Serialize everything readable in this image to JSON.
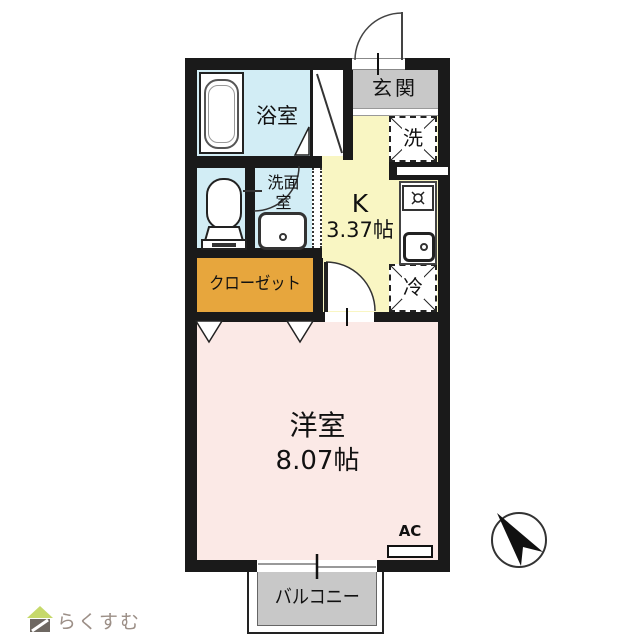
{
  "colors": {
    "wall": "#1a1a1a",
    "wet": "#d2edf5",
    "kitchen": "#f9f6c3",
    "closet": "#e7a63d",
    "bedroom": "#fbe9e6",
    "gray": "#c8c8c8",
    "logo-green": "#c6d96a",
    "logo-body": "#6e6862",
    "logo-text": "#9c8f87"
  },
  "rooms": {
    "entrance": {
      "label": "玄関"
    },
    "bathroom": {
      "label": "浴室"
    },
    "washroom": {
      "label_line1": "洗面",
      "label_line2": "室"
    },
    "kitchen": {
      "label": "K",
      "size": "3.37帖"
    },
    "closet": {
      "label": "クローゼット"
    },
    "bedroom": {
      "label": "洋室",
      "size": "8.07帖"
    },
    "balcony": {
      "label": "バルコニー"
    }
  },
  "fixtures": {
    "washer": {
      "label": "洗"
    },
    "fridge": {
      "label": "冷"
    },
    "ac": {
      "label": "AC"
    }
  },
  "branding": {
    "logo_text": "らくすむ"
  }
}
